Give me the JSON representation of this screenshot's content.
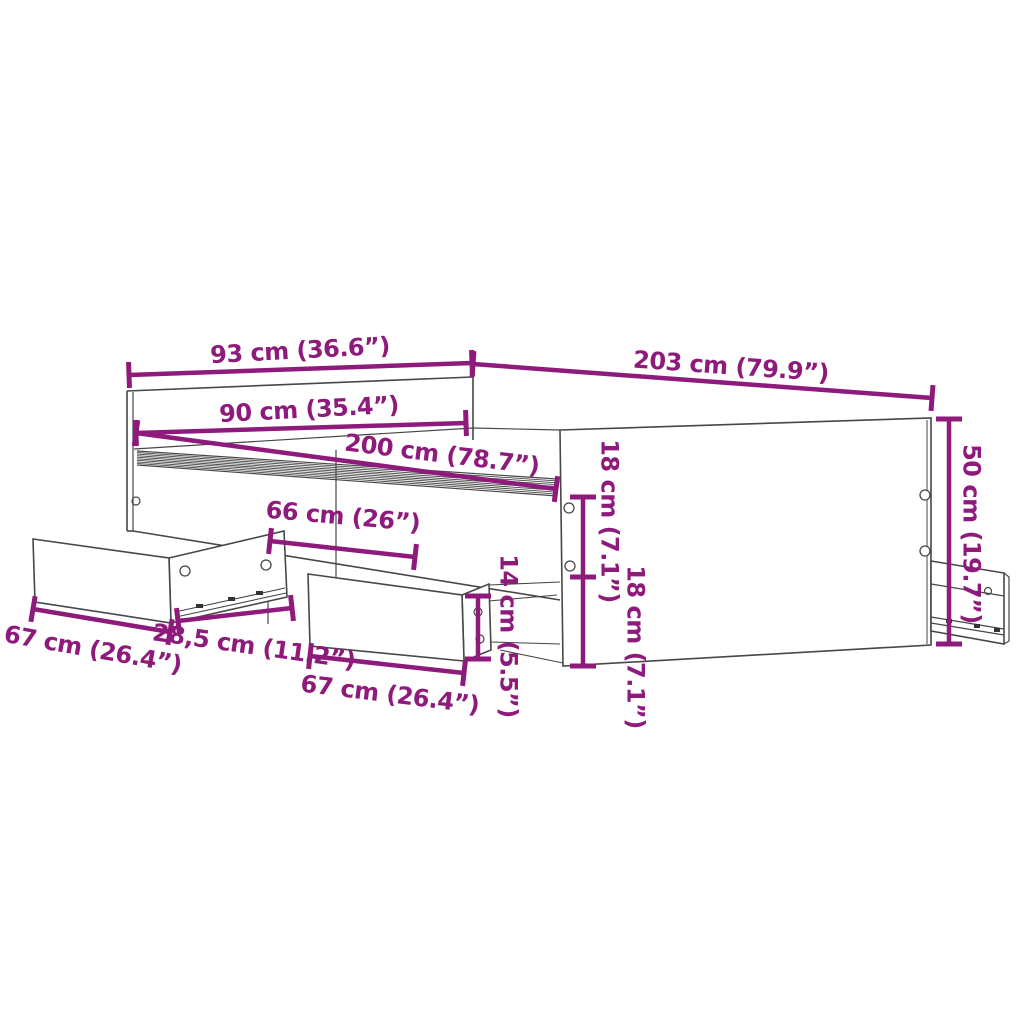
{
  "diagram": {
    "type": "product-dimension-diagram",
    "subject": "bed-frame-with-storage-drawers",
    "colors": {
      "dimension": "#8E1A7B",
      "outline": "#474747",
      "background": "#FFFFFF"
    },
    "dimensions": [
      {
        "id": "headboard-width",
        "label": "93 cm (36.6”)"
      },
      {
        "id": "bed-length",
        "label": "203 cm (79.9”)"
      },
      {
        "id": "headboard-inner-width",
        "label": "90 cm (35.4”)"
      },
      {
        "id": "mattress-length",
        "label": "200 cm (78.7”)"
      },
      {
        "id": "drawer-opening-width",
        "label": "66 cm (26”)"
      },
      {
        "id": "rail-height-upper",
        "label": "18 cm (7.1”)"
      },
      {
        "id": "rail-height-lower",
        "label": "18 cm (7.1”)"
      },
      {
        "id": "drawer-front-height",
        "label": "14 cm (5.5”)"
      },
      {
        "id": "footboard-height",
        "label": "50 cm (19.7”)"
      },
      {
        "id": "drawer-left-width",
        "label": "67 cm (26.4”)"
      },
      {
        "id": "drawer-offset-width",
        "label": "28,5 cm (11.2”)"
      },
      {
        "id": "drawer-middle-width",
        "label": "67 cm (26.4”)"
      }
    ]
  }
}
